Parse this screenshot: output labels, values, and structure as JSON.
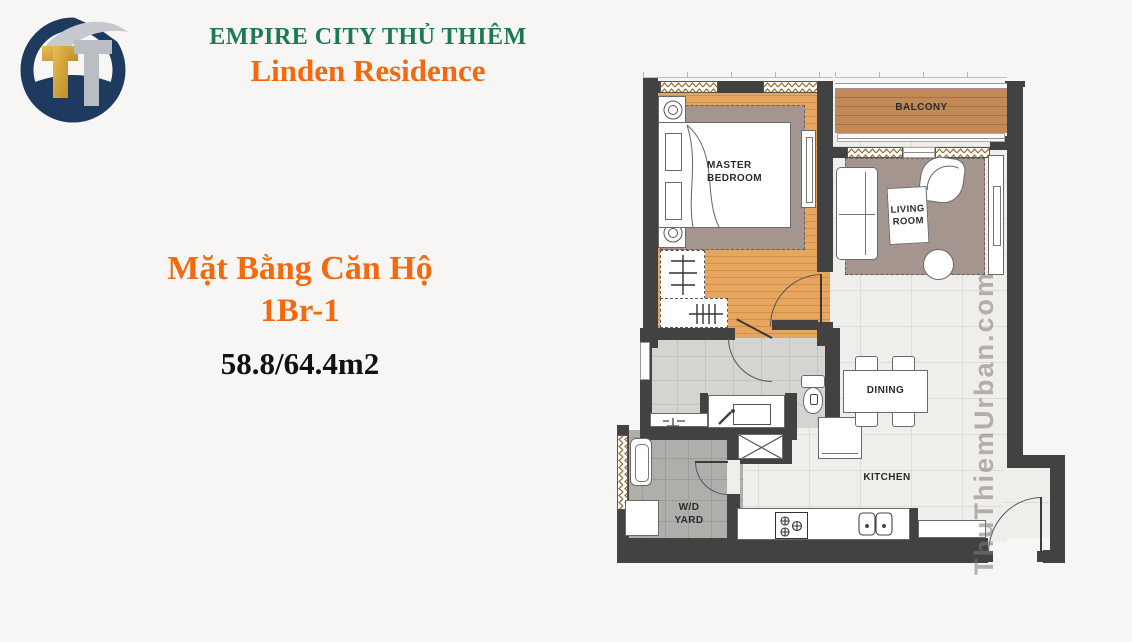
{
  "header": {
    "logo_monogram": "TT",
    "brand_line1": "EMPIRE CITY THỦ THIÊM",
    "brand_line2": "Linden Residence"
  },
  "title": {
    "heading_line1": "Mặt Bằng Căn Hộ",
    "heading_line2": "1Br-1",
    "area_text": "58.8/64.4m2"
  },
  "floorplan": {
    "watermark": "ThuThiemUrban.com",
    "rooms": {
      "master_bedroom": "MASTER BEDROOM",
      "balcony": "BALCONY",
      "living_room": "LIVING ROOM",
      "dining": "DINING",
      "kitchen": "KITCHEN",
      "wd_yard": "W/D YARD"
    }
  },
  "colors": {
    "brand_green": "#1b7a4e",
    "brand_orange": "#f4690e",
    "area_black": "#111111",
    "logo_navy": "#1e3a5f",
    "logo_gold": "#d8a53a",
    "logo_silver": "#b9bdc4",
    "wall_dark": "#424242",
    "wood_floor": "#e7a65f",
    "balcony_deck": "#bf8756",
    "rug_taupe": "#a5958f",
    "tile_light": "#efeeeb",
    "bath_gray": "#d6d4d1",
    "yard_gray": "#b0aeab",
    "watermark_gray": "#8e8c89"
  }
}
